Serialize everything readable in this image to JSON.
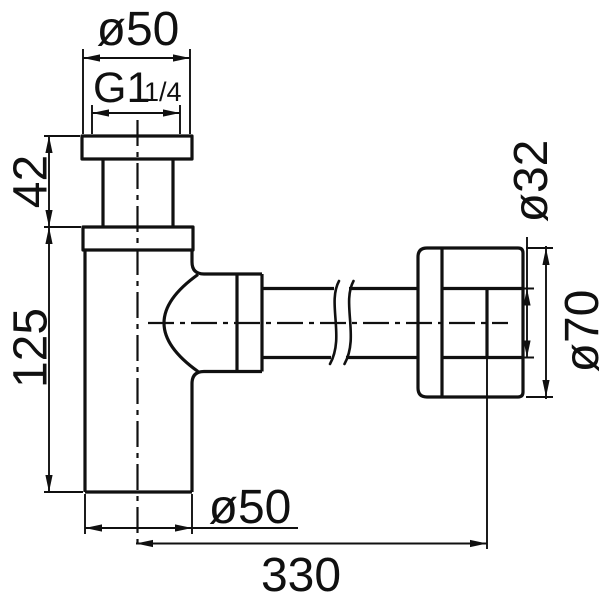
{
  "style": {
    "line_color": "#101010",
    "bg_color": "#ffffff"
  },
  "labels": {
    "top_diameter": "ø50",
    "thread": {
      "main": "G1",
      "frac": "1/4"
    },
    "inlet_height": "42",
    "body_height": "125",
    "bottom_diameter": "ø50",
    "total_length": "330",
    "pipe_diameter": "ø32",
    "flange_diameter": "ø70"
  }
}
